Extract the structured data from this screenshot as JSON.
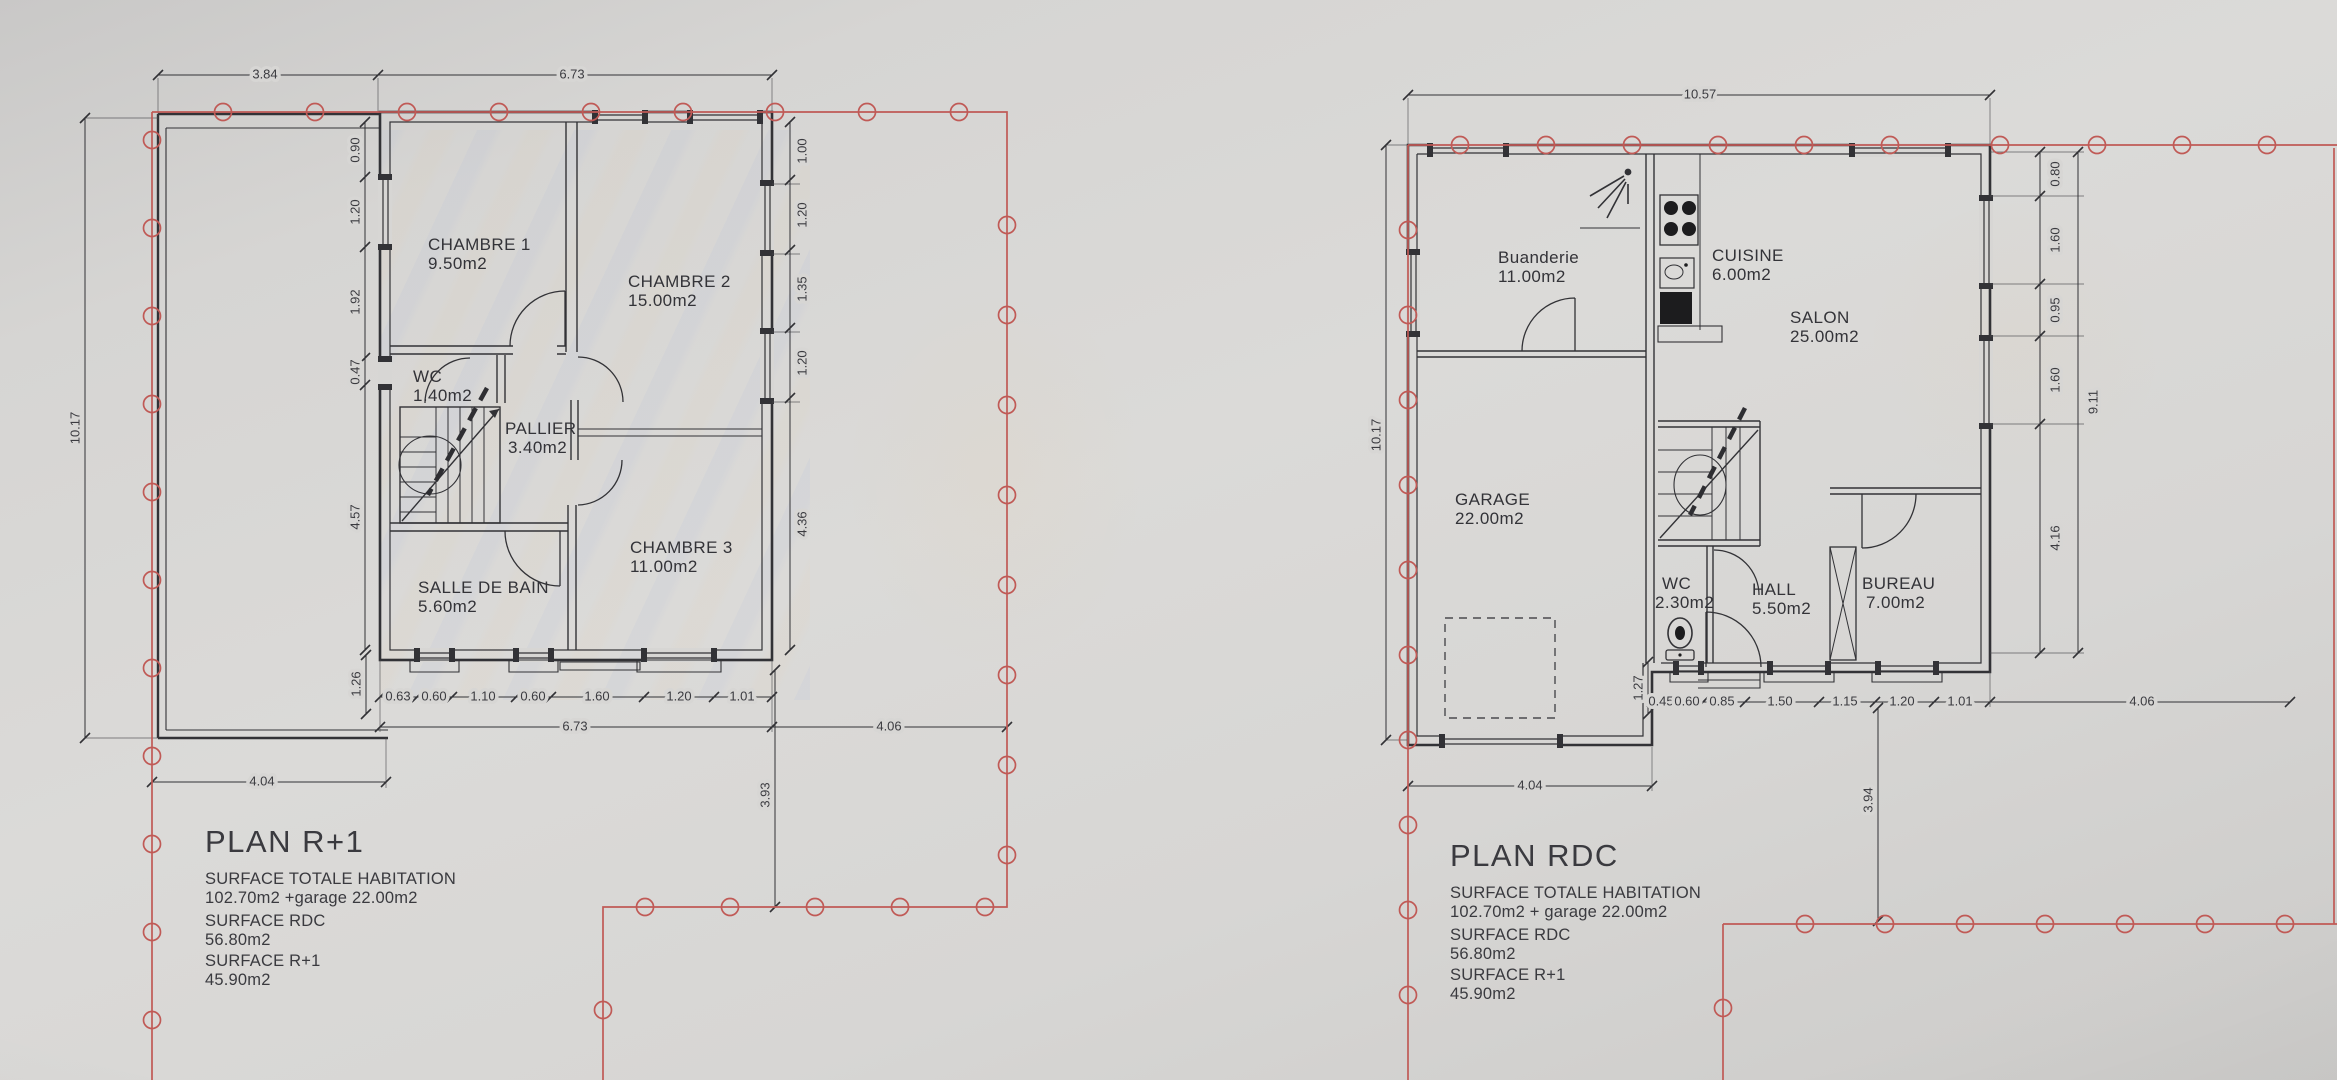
{
  "colors": {
    "drawing_line": "#323236",
    "boundary_red": "#c05a56",
    "paper": "#d7d6d4",
    "text": "#3a3a3f"
  },
  "plans": [
    {
      "title": "PLAN R+1",
      "summary": [
        "SURFACE TOTALE HABITATION",
        "102.70m2 +garage 22.00m2",
        "SURFACE RDC",
        "56.80m2",
        "SURFACE R+1",
        "45.90m2"
      ],
      "rooms": [
        {
          "name": "CHAMBRE 1",
          "area": "9.50m2"
        },
        {
          "name": "CHAMBRE 2",
          "area": "15.00m2"
        },
        {
          "name": "WC",
          "area": "1.40m2"
        },
        {
          "name": "PALLIER",
          "area": "3.40m2"
        },
        {
          "name": "SALLE DE BAIN",
          "area": "5.60m2"
        },
        {
          "name": "CHAMBRE 3",
          "area": "11.00m2"
        }
      ],
      "dimensions": {
        "top": [
          "3.84",
          "6.73"
        ],
        "left_overall": "10.17",
        "left_chain": [
          "0.90",
          "1.20",
          "1.92",
          "0.47",
          "4.57"
        ],
        "right_chain": [
          "1.00",
          "1.20",
          "1.35",
          "1.20",
          "4.36"
        ],
        "bottom_chain": [
          "0.63",
          "0.60",
          "1.10",
          "0.60",
          "1.60",
          "1.20",
          "1.01"
        ],
        "bottom_total": "6.73",
        "bottom_right": "4.06",
        "bottom_left": "4.04",
        "offset_small": "1.26",
        "to_boundary": "3.93"
      }
    },
    {
      "title": "PLAN RDC",
      "summary": [
        "SURFACE TOTALE HABITATION",
        "102.70m2 + garage 22.00m2",
        "SURFACE RDC",
        "56.80m2",
        "SURFACE R+1",
        "45.90m2"
      ],
      "rooms": [
        {
          "name": "Buanderie",
          "area": "11.00m2"
        },
        {
          "name": "CUISINE",
          "area": "6.00m2"
        },
        {
          "name": "SALON",
          "area": "25.00m2"
        },
        {
          "name": "GARAGE",
          "area": "22.00m2"
        },
        {
          "name": "WC",
          "area": "2.30m2"
        },
        {
          "name": "HALL",
          "area": "5.50m2"
        },
        {
          "name": "BUREAU",
          "area": "7.00m2"
        }
      ],
      "dimensions": {
        "top_total": "10.57",
        "left_overall": "10.17",
        "right_chain": [
          "0.80",
          "1.60",
          "0.95",
          "1.60",
          "4.16"
        ],
        "right_total": "9.11",
        "bottom_chain": [
          "0.45",
          "0.60",
          "0.85",
          "1.50",
          "1.15",
          "1.20",
          "1.01"
        ],
        "bottom_total": "4.04",
        "bottom_right": "4.06",
        "offset_small": "1.27",
        "to_boundary": "3.94"
      }
    }
  ]
}
